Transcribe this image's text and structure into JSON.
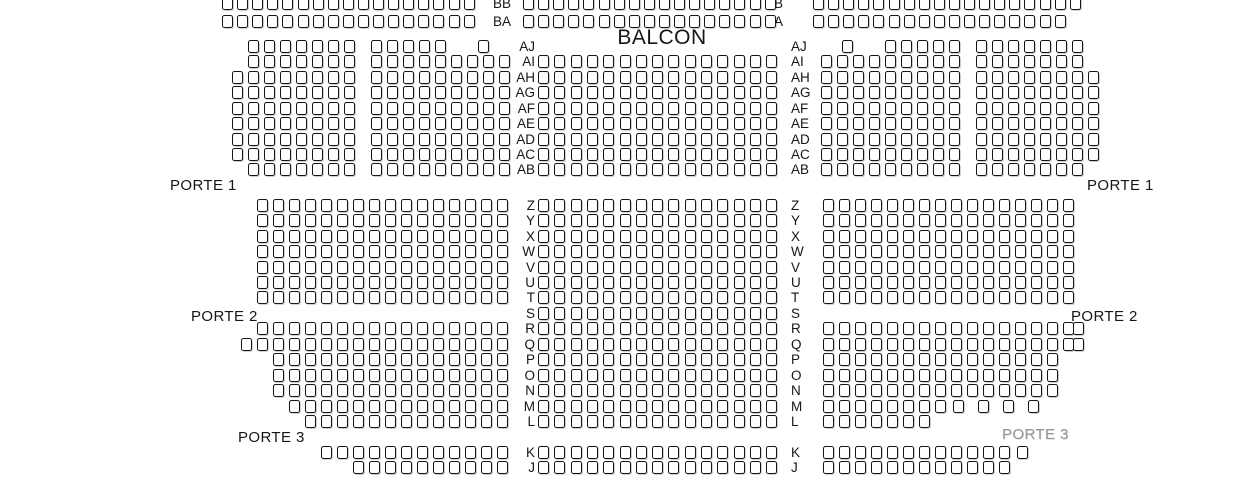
{
  "seat_map": {
    "title": "BALCON",
    "colors": {
      "background": "#ffffff",
      "seat_outline": "#151515",
      "text": "#161616",
      "muted_label": "#969696"
    },
    "seat": {
      "w": 11,
      "h": 13,
      "pitch": 16
    },
    "porte_labels": [
      {
        "text": "PORTE 1",
        "x": 170,
        "y": 177,
        "side": "left",
        "muted": false
      },
      {
        "text": "PORTE 1",
        "x": 1087,
        "y": 177,
        "side": "right",
        "muted": false
      },
      {
        "text": "PORTE 2",
        "x": 191,
        "y": 308,
        "side": "left",
        "muted": false
      },
      {
        "text": "PORTE 2",
        "x": 1071,
        "y": 308,
        "side": "right",
        "muted": false
      },
      {
        "text": "PORTE 3",
        "x": 238,
        "y": 429,
        "side": "left",
        "muted": false
      },
      {
        "text": "PORTE 3",
        "x": 1002,
        "y": 426,
        "side": "right",
        "muted": true
      }
    ],
    "rows": [
      {
        "label": "BB",
        "y": -3,
        "label_left_x": 511,
        "label_right_x": 765,
        "left": [
          {
            "x": 222,
            "n": 17,
            "p": 15.1
          }
        ],
        "center": [
          {
            "x": 523,
            "n": 17,
            "p": 15.1
          }
        ],
        "right": [
          {
            "x": 813,
            "n": 18,
            "p": 15.1
          }
        ]
      },
      {
        "label": "BA",
        "y": 15,
        "label_left_x": 511,
        "label_right_x": 765,
        "left": [
          {
            "x": 222,
            "n": 17,
            "p": 15.1
          }
        ],
        "center": [
          {
            "x": 523,
            "n": 17,
            "p": 15.1
          }
        ],
        "right": [
          {
            "x": 813,
            "n": 17,
            "p": 15.1
          }
        ]
      },
      {
        "label": "AJ",
        "y": 40,
        "label_left_x": 535,
        "label_right_x": 791,
        "left": [
          {
            "x": 248,
            "n": 7
          },
          {
            "x": 371,
            "n": 5
          },
          {
            "x": 478,
            "n": 1
          }
        ],
        "center": [],
        "right": [
          {
            "x": 842,
            "n": 1
          },
          {
            "x": 885,
            "n": 5
          },
          {
            "x": 976,
            "n": 7
          }
        ]
      },
      {
        "label": "AI",
        "y": 55,
        "label_left_x": 535,
        "label_right_x": 791,
        "left": [
          {
            "x": 248,
            "n": 7
          },
          {
            "x": 371,
            "n": 9
          }
        ],
        "center": [
          {
            "x": 538,
            "n": 15,
            "p": 16.3
          }
        ],
        "right": [
          {
            "x": 821,
            "n": 9
          },
          {
            "x": 976,
            "n": 7
          }
        ]
      },
      {
        "label": "AH",
        "y": 71,
        "label_left_x": 535,
        "label_right_x": 791,
        "left": [
          {
            "x": 232,
            "n": 8
          },
          {
            "x": 371,
            "n": 9
          }
        ],
        "center": [
          {
            "x": 538,
            "n": 15,
            "p": 16.3
          }
        ],
        "right": [
          {
            "x": 821,
            "n": 9
          },
          {
            "x": 976,
            "n": 8
          }
        ]
      },
      {
        "label": "AG",
        "y": 86,
        "label_left_x": 535,
        "label_right_x": 791,
        "left": [
          {
            "x": 232,
            "n": 8
          },
          {
            "x": 371,
            "n": 9
          }
        ],
        "center": [
          {
            "x": 538,
            "n": 15,
            "p": 16.3
          }
        ],
        "right": [
          {
            "x": 821,
            "n": 9
          },
          {
            "x": 976,
            "n": 8
          }
        ]
      },
      {
        "label": "AF",
        "y": 102,
        "label_left_x": 535,
        "label_right_x": 791,
        "left": [
          {
            "x": 232,
            "n": 8
          },
          {
            "x": 371,
            "n": 9
          }
        ],
        "center": [
          {
            "x": 538,
            "n": 15,
            "p": 16.3
          }
        ],
        "right": [
          {
            "x": 821,
            "n": 9
          },
          {
            "x": 976,
            "n": 8
          }
        ]
      },
      {
        "label": "AE",
        "y": 117,
        "label_left_x": 535,
        "label_right_x": 791,
        "left": [
          {
            "x": 232,
            "n": 8
          },
          {
            "x": 371,
            "n": 9
          }
        ],
        "center": [
          {
            "x": 538,
            "n": 15,
            "p": 16.3
          }
        ],
        "right": [
          {
            "x": 821,
            "n": 9
          },
          {
            "x": 976,
            "n": 8
          }
        ]
      },
      {
        "label": "AD",
        "y": 133,
        "label_left_x": 535,
        "label_right_x": 791,
        "left": [
          {
            "x": 232,
            "n": 8
          },
          {
            "x": 371,
            "n": 9
          }
        ],
        "center": [
          {
            "x": 538,
            "n": 15,
            "p": 16.3
          }
        ],
        "right": [
          {
            "x": 821,
            "n": 9
          },
          {
            "x": 976,
            "n": 8
          }
        ]
      },
      {
        "label": "AC",
        "y": 148,
        "label_left_x": 535,
        "label_right_x": 791,
        "left": [
          {
            "x": 232,
            "n": 8
          },
          {
            "x": 371,
            "n": 9
          }
        ],
        "center": [
          {
            "x": 538,
            "n": 15,
            "p": 16.3
          }
        ],
        "right": [
          {
            "x": 821,
            "n": 9
          },
          {
            "x": 976,
            "n": 8
          }
        ]
      },
      {
        "label": "AB",
        "y": 163,
        "label_left_x": 535,
        "label_right_x": 791,
        "left": [
          {
            "x": 248,
            "n": 7
          },
          {
            "x": 371,
            "n": 9
          }
        ],
        "center": [
          {
            "x": 538,
            "n": 15,
            "p": 16.3
          }
        ],
        "right": [
          {
            "x": 821,
            "n": 9
          },
          {
            "x": 976,
            "n": 7
          }
        ]
      },
      {
        "label": "Z",
        "y": 199,
        "label_left_x": 535,
        "label_right_x": 791,
        "left": [
          {
            "x": 257,
            "n": 16
          }
        ],
        "center": [
          {
            "x": 538,
            "n": 15,
            "p": 16.3
          }
        ],
        "right": [
          {
            "x": 823,
            "n": 16
          }
        ]
      },
      {
        "label": "Y",
        "y": 214,
        "label_left_x": 535,
        "label_right_x": 791,
        "left": [
          {
            "x": 257,
            "n": 16
          }
        ],
        "center": [
          {
            "x": 538,
            "n": 15,
            "p": 16.3
          }
        ],
        "right": [
          {
            "x": 823,
            "n": 16
          }
        ]
      },
      {
        "label": "X",
        "y": 230,
        "label_left_x": 535,
        "label_right_x": 791,
        "left": [
          {
            "x": 257,
            "n": 16
          }
        ],
        "center": [
          {
            "x": 538,
            "n": 15,
            "p": 16.3
          }
        ],
        "right": [
          {
            "x": 823,
            "n": 16
          }
        ]
      },
      {
        "label": "W",
        "y": 245,
        "label_left_x": 535,
        "label_right_x": 791,
        "left": [
          {
            "x": 257,
            "n": 16
          }
        ],
        "center": [
          {
            "x": 538,
            "n": 15,
            "p": 16.3
          }
        ],
        "right": [
          {
            "x": 823,
            "n": 16
          }
        ]
      },
      {
        "label": "V",
        "y": 261,
        "label_left_x": 535,
        "label_right_x": 791,
        "left": [
          {
            "x": 257,
            "n": 16
          }
        ],
        "center": [
          {
            "x": 538,
            "n": 15,
            "p": 16.3
          }
        ],
        "right": [
          {
            "x": 823,
            "n": 16
          }
        ]
      },
      {
        "label": "U",
        "y": 276,
        "label_left_x": 535,
        "label_right_x": 791,
        "left": [
          {
            "x": 257,
            "n": 16
          }
        ],
        "center": [
          {
            "x": 538,
            "n": 15,
            "p": 16.3
          }
        ],
        "right": [
          {
            "x": 823,
            "n": 16
          }
        ]
      },
      {
        "label": "T",
        "y": 291,
        "label_left_x": 535,
        "label_right_x": 791,
        "left": [
          {
            "x": 257,
            "n": 16
          }
        ],
        "center": [
          {
            "x": 538,
            "n": 15,
            "p": 16.3
          }
        ],
        "right": [
          {
            "x": 823,
            "n": 16
          }
        ]
      },
      {
        "label": "S",
        "y": 307,
        "label_left_x": 535,
        "label_right_x": 791,
        "left": [],
        "center": [
          {
            "x": 538,
            "n": 15,
            "p": 16.3
          }
        ],
        "right": []
      },
      {
        "label": "R",
        "y": 322,
        "label_left_x": 535,
        "label_right_x": 791,
        "left": [
          {
            "x": 257,
            "n": 16
          }
        ],
        "center": [
          {
            "x": 538,
            "n": 15,
            "p": 16.3
          }
        ],
        "right": [
          {
            "x": 823,
            "n": 16
          },
          {
            "x": 1073,
            "n": 1
          }
        ]
      },
      {
        "label": "Q",
        "y": 338,
        "label_left_x": 535,
        "label_right_x": 791,
        "left": [
          {
            "x": 241,
            "n": 17
          }
        ],
        "center": [
          {
            "x": 538,
            "n": 15,
            "p": 16.3
          }
        ],
        "right": [
          {
            "x": 823,
            "n": 16
          },
          {
            "x": 1073,
            "n": 1
          }
        ]
      },
      {
        "label": "P",
        "y": 353,
        "label_left_x": 535,
        "label_right_x": 791,
        "left": [
          {
            "x": 273,
            "n": 15
          }
        ],
        "center": [
          {
            "x": 538,
            "n": 15,
            "p": 16.3
          }
        ],
        "right": [
          {
            "x": 823,
            "n": 15
          }
        ]
      },
      {
        "label": "O",
        "y": 369,
        "label_left_x": 535,
        "label_right_x": 791,
        "left": [
          {
            "x": 273,
            "n": 15
          }
        ],
        "center": [
          {
            "x": 538,
            "n": 15,
            "p": 16.3
          }
        ],
        "right": [
          {
            "x": 823,
            "n": 15
          }
        ]
      },
      {
        "label": "N",
        "y": 384,
        "label_left_x": 535,
        "label_right_x": 791,
        "left": [
          {
            "x": 273,
            "n": 15
          }
        ],
        "center": [
          {
            "x": 538,
            "n": 15,
            "p": 16.3
          }
        ],
        "right": [
          {
            "x": 823,
            "n": 15
          }
        ]
      },
      {
        "label": "M",
        "y": 400,
        "label_left_x": 535,
        "label_right_x": 791,
        "left": [
          {
            "x": 289,
            "n": 14
          }
        ],
        "center": [
          {
            "x": 538,
            "n": 15,
            "p": 16.3
          }
        ],
        "right": [
          {
            "x": 823,
            "n": 8
          },
          {
            "x": 953,
            "n": 4,
            "p": 25
          }
        ]
      },
      {
        "label": "L",
        "y": 415,
        "label_left_x": 535,
        "label_right_x": 791,
        "left": [
          {
            "x": 305,
            "n": 13
          }
        ],
        "center": [
          {
            "x": 538,
            "n": 15,
            "p": 16.3
          }
        ],
        "right": [
          {
            "x": 823,
            "n": 7
          }
        ]
      },
      {
        "label": "K",
        "y": 446,
        "label_left_x": 535,
        "label_right_x": 791,
        "left": [
          {
            "x": 321,
            "n": 1
          },
          {
            "x": 337,
            "n": 11
          }
        ],
        "center": [
          {
            "x": 538,
            "n": 15,
            "p": 16.3
          }
        ],
        "right": [
          {
            "x": 823,
            "n": 12
          },
          {
            "x": 1017,
            "n": 1
          }
        ]
      },
      {
        "label": "J",
        "y": 461,
        "label_left_x": 535,
        "label_right_x": 791,
        "left": [
          {
            "x": 353,
            "n": 10
          }
        ],
        "center": [
          {
            "x": 538,
            "n": 15,
            "p": 16.3
          }
        ],
        "right": [
          {
            "x": 823,
            "n": 12
          }
        ]
      }
    ]
  }
}
